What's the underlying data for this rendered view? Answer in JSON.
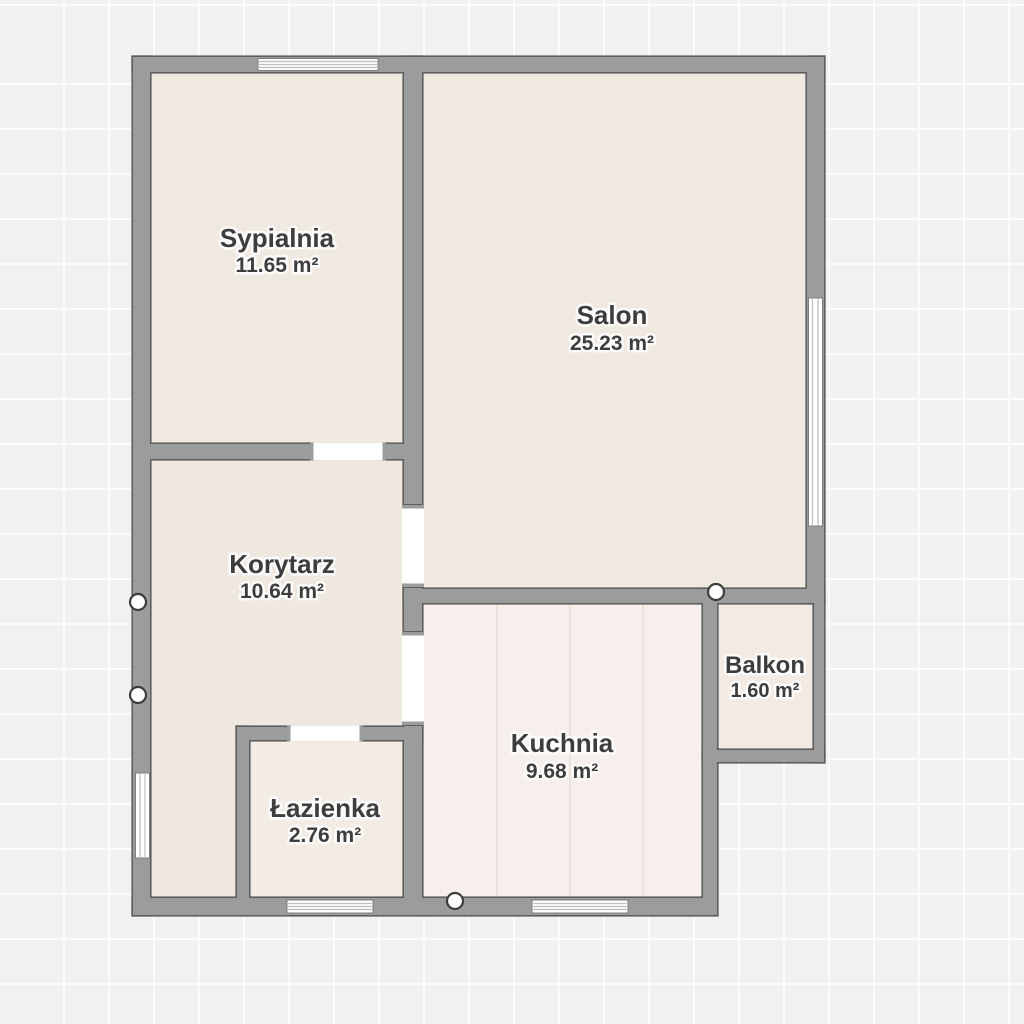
{
  "plan": {
    "type": "floor-plan",
    "rooms": [
      {
        "id": "sypialnia",
        "name": "Sypialnia",
        "area": "11.65 m²"
      },
      {
        "id": "salon",
        "name": "Salon",
        "area": "25.23 m²"
      },
      {
        "id": "korytarz",
        "name": "Korytarz",
        "area": "10.64 m²"
      },
      {
        "id": "kuchnia",
        "name": "Kuchnia",
        "area": "9.68 m²"
      },
      {
        "id": "lazienka",
        "name": "Łazienka",
        "area": "2.76 m²"
      },
      {
        "id": "balkon",
        "name": "Balkon",
        "area": "1.60 m²"
      }
    ],
    "colors": {
      "canvas_background": "#f1f1f4",
      "grid_line": "#fbfbfd",
      "wall_fill": "#9c9c9c",
      "wall_outline": "#5f5f5f",
      "floor_beige": "#f0e9e1",
      "floor_bathroom": "#f2ece5",
      "floor_kitchen": "#f7efec",
      "floor_balcony": "#f2eae3",
      "opening_white": "#ffffff",
      "label_text": "#3d3d3d"
    }
  }
}
